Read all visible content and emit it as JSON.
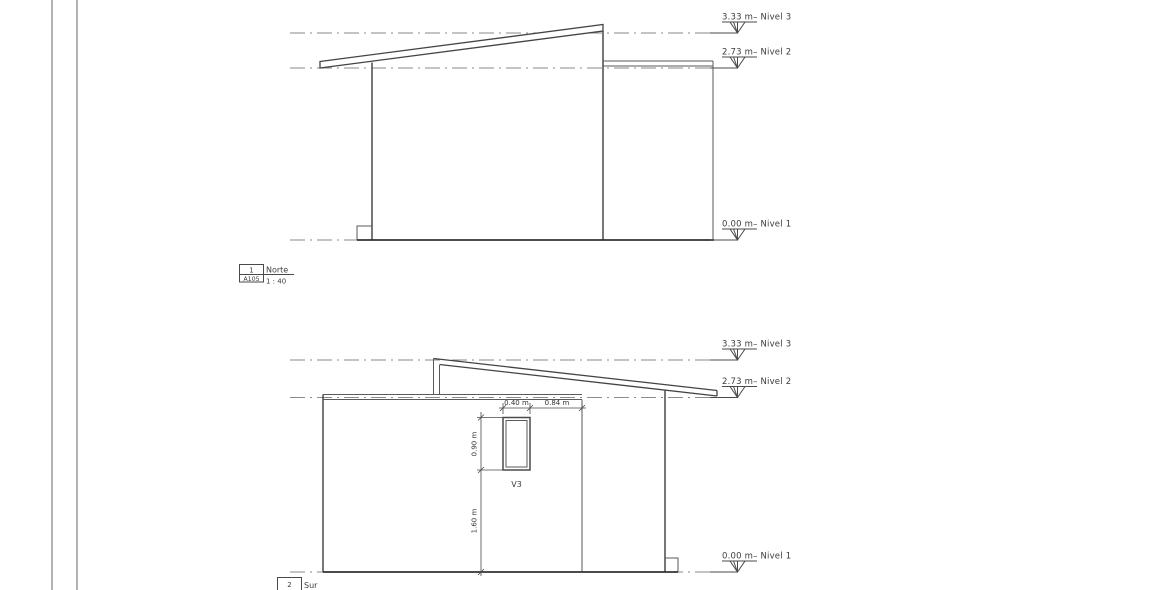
{
  "sheet": {
    "type": "architectural-elevations"
  },
  "norte": {
    "levels": [
      "3.33 m– Nivel 3",
      "2.73 m– Nivel 2",
      "0.00 m– Nivel 1"
    ],
    "title": {
      "number": "1",
      "sheet": "A105",
      "name": "Norte",
      "scale": "1 : 40"
    }
  },
  "sur": {
    "levels": [
      "3.33 m– Nivel 3",
      "2.73 m– Nivel 2",
      "0.00 m– Nivel 1"
    ],
    "title": {
      "number": "2",
      "name": "Sur"
    },
    "window": {
      "label": "V3",
      "width": "0.40 m",
      "right_offset": "0.84 m",
      "height": "0.90 m",
      "sill_height": "1.60 m"
    }
  },
  "colors": {
    "line": "#4a4a4a",
    "levelline": "#8a8a8a",
    "background": "#ffffff"
  }
}
